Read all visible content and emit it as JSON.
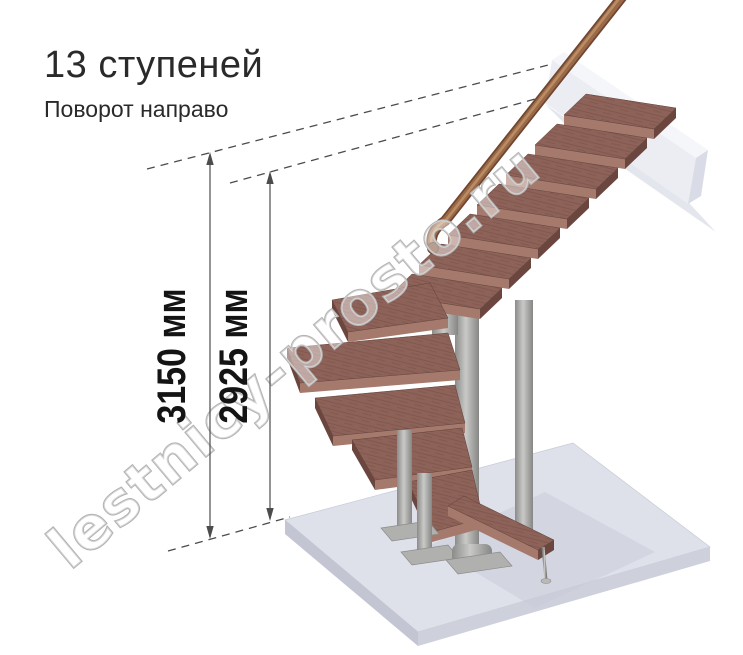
{
  "header": {
    "title": "13 ступеней",
    "subtitle": "Поворот направо"
  },
  "stairs": {
    "steps_count": "13",
    "turn_direction": "направо"
  },
  "dimensions": {
    "total_height": {
      "label": "3150 мм"
    },
    "height_to_top_step": {
      "label": "2925 мм"
    }
  },
  "watermark": {
    "text": "lestnicy-prosto.ru"
  },
  "colors": {
    "wood": "#8d6359",
    "wood_front": "#a5796b",
    "wood_side": "#6b463f",
    "handrail": "#9a6a48",
    "metal": "#a9a9a7",
    "floor_top": "#dfe1ea",
    "beam_front": "#ebedf3",
    "dimension_line": "#4c4c4c",
    "text": "#2a2a2a",
    "watermark_outline": "#b2b2b2"
  }
}
